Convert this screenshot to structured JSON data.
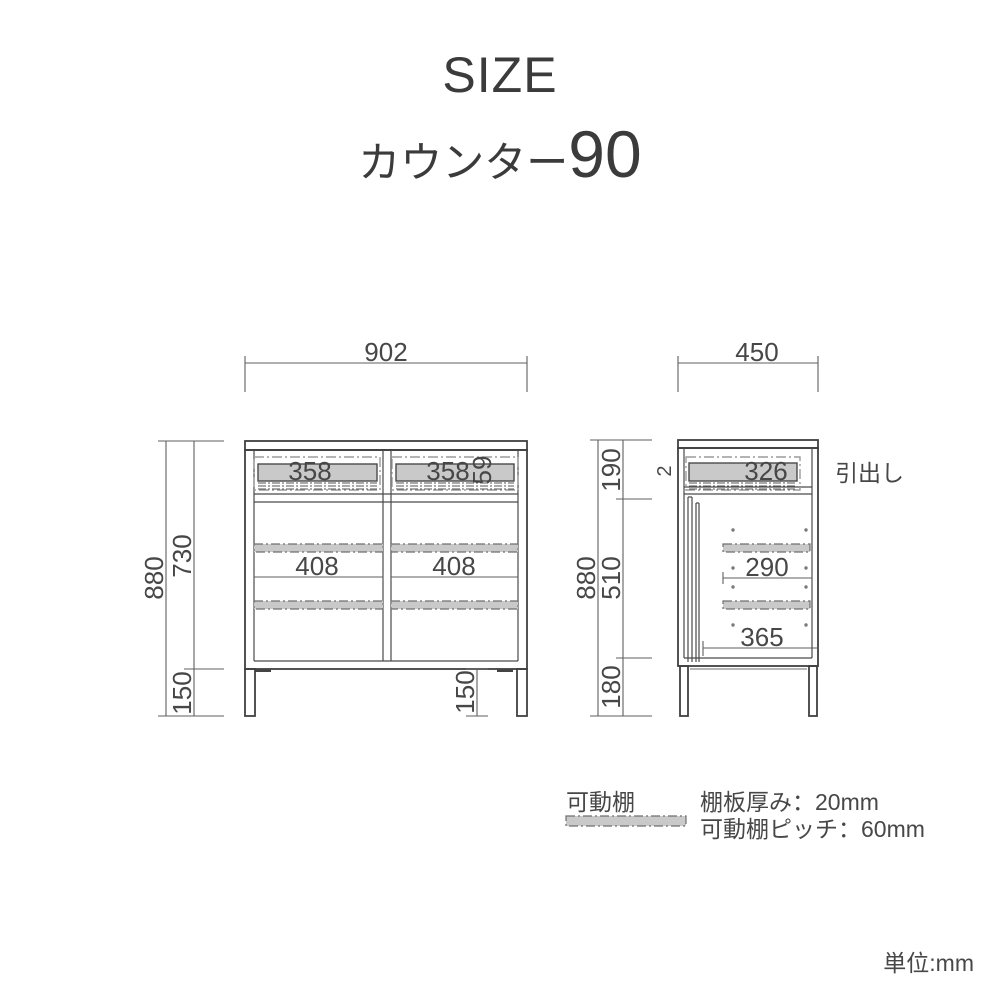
{
  "title": "SIZE",
  "subtitle": {
    "name": "カウンター",
    "number": "90"
  },
  "front_view": {
    "width_total": "902",
    "height_total": "880",
    "height_body": "730",
    "leg_height_left": "150",
    "leg_height_right": "150",
    "drawer_left_width": "358",
    "drawer_right_width": "358",
    "drawer_inner_height": "59",
    "shelf_left_width": "408",
    "shelf_right_width": "408"
  },
  "side_view": {
    "depth_total": "450",
    "height_total": "880",
    "section_top": "190",
    "section_middle": "510",
    "section_bottom": "180",
    "drawer_depth": "326",
    "partial_digit": "2",
    "shelf_depth": "290",
    "interior_depth": "365",
    "drawer_callout": "引出し"
  },
  "legend": {
    "movable_shelf_label": "可動棚",
    "shelf_thickness": "棚板厚み：20mm",
    "shelf_pitch": "可動棚ピッチ：60mm"
  },
  "footer": {
    "unit": "単位:mm"
  },
  "colors": {
    "object_line": "#404040",
    "dimension_line": "#5f5f5f",
    "text": "#474747",
    "movable_shelf_fill": "#c9c9c9"
  }
}
